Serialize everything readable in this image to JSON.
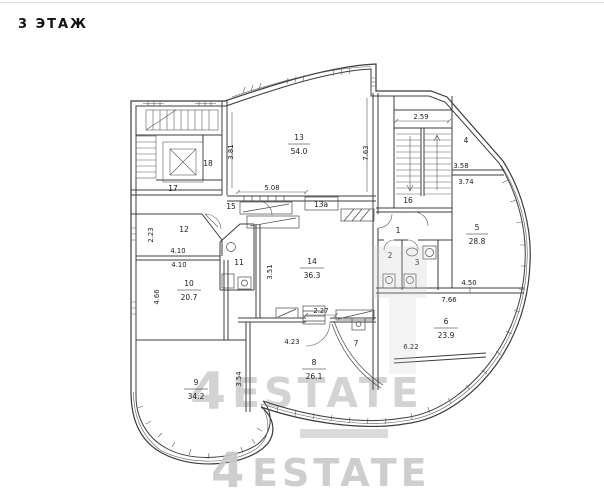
{
  "page": {
    "title": "3 ЭТАЖ"
  },
  "watermarks": {
    "center_4": "4",
    "center_word": "ESTATE",
    "bottom_4": "4",
    "bottom_word": "ESTATE"
  },
  "rooms": {
    "r13": {
      "number": "13",
      "area": "54.0"
    },
    "r14": {
      "number": "14",
      "area": "36.3"
    },
    "r5": {
      "number": "5",
      "area": "28.8"
    },
    "r6": {
      "number": "6",
      "area": "23.9"
    },
    "r8": {
      "number": "8",
      "area": "26.1"
    },
    "r9": {
      "number": "9",
      "area": "34.2"
    },
    "r10": {
      "number": "10",
      "area": "20.7"
    },
    "r1": {
      "number": "1"
    },
    "r2": {
      "number": "2"
    },
    "r3": {
      "number": "3"
    },
    "r4": {
      "number": "4"
    },
    "r7": {
      "number": "7"
    },
    "r11": {
      "number": "11"
    },
    "r12": {
      "number": "12"
    },
    "r13a": {
      "number": "13а"
    },
    "r15": {
      "number": "15"
    },
    "r16": {
      "number": "16"
    },
    "r17": {
      "number": "17"
    },
    "r18": {
      "number": "18"
    }
  },
  "dimensions": {
    "v_381": "3.81",
    "h_508": "5.08",
    "v_763": "7.63",
    "h_259": "2.59",
    "h_358": "3.58",
    "h_374": "3.74",
    "h_410_top": "4.10",
    "h_410_bottom": "4.10",
    "v_223": "2.23",
    "v_466": "4.66",
    "v_351": "3.51",
    "h_227": "2.27",
    "h_423": "4.23",
    "v_354": "3.54",
    "h_450": "4.50",
    "h_766": "7.66",
    "h_622": "6.22"
  }
}
